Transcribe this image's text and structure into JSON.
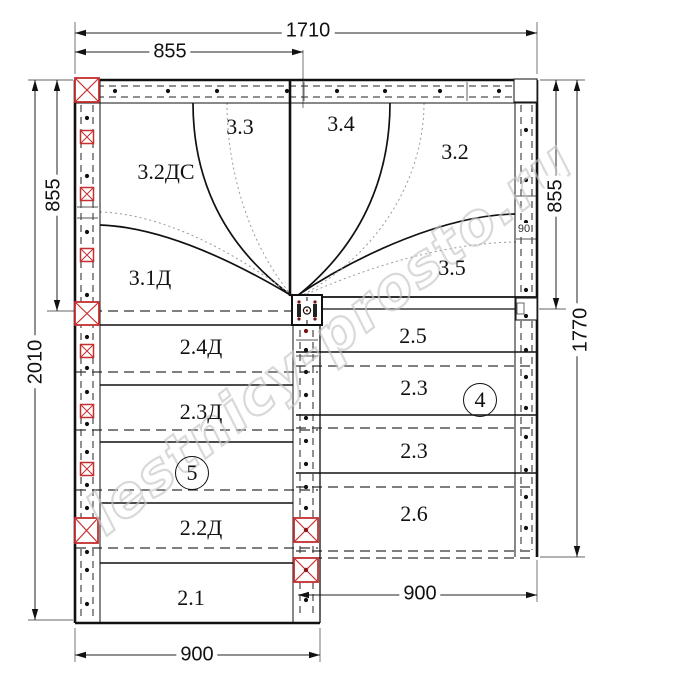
{
  "watermark": {
    "text": "lestnicy-prosto.ru"
  },
  "dims": {
    "top_total": "1710",
    "top_half": "855",
    "left_upper": "855",
    "left_total": "2010",
    "right_upper": "855",
    "right_total": "1770",
    "bottom_left": "900",
    "bottom_right": "900",
    "winder_gap": "90"
  },
  "steps": {
    "s33": "3.3",
    "s34": "3.4",
    "s32ds": "3.2ДС",
    "s32": "3.2",
    "s31d": "3.1Д",
    "s35": "3.5",
    "s24d": "2.4Д",
    "s25": "2.5",
    "s23d": "2.3Д",
    "s23a": "2.3",
    "s23b": "2.3",
    "s22d": "2.2Д",
    "s26": "2.6",
    "s21": "2.1"
  },
  "markers": {
    "left_flight": "5",
    "right_flight": "4"
  },
  "colors": {
    "post_marker_red": "#c53030",
    "line_black": "#111111",
    "watermark_gray": "#c5c5c5"
  },
  "icons": {
    "red_cross_post": "newel/baluster anchor marker",
    "white_post": "corner post",
    "center_post": "central newel post with fasteners"
  }
}
